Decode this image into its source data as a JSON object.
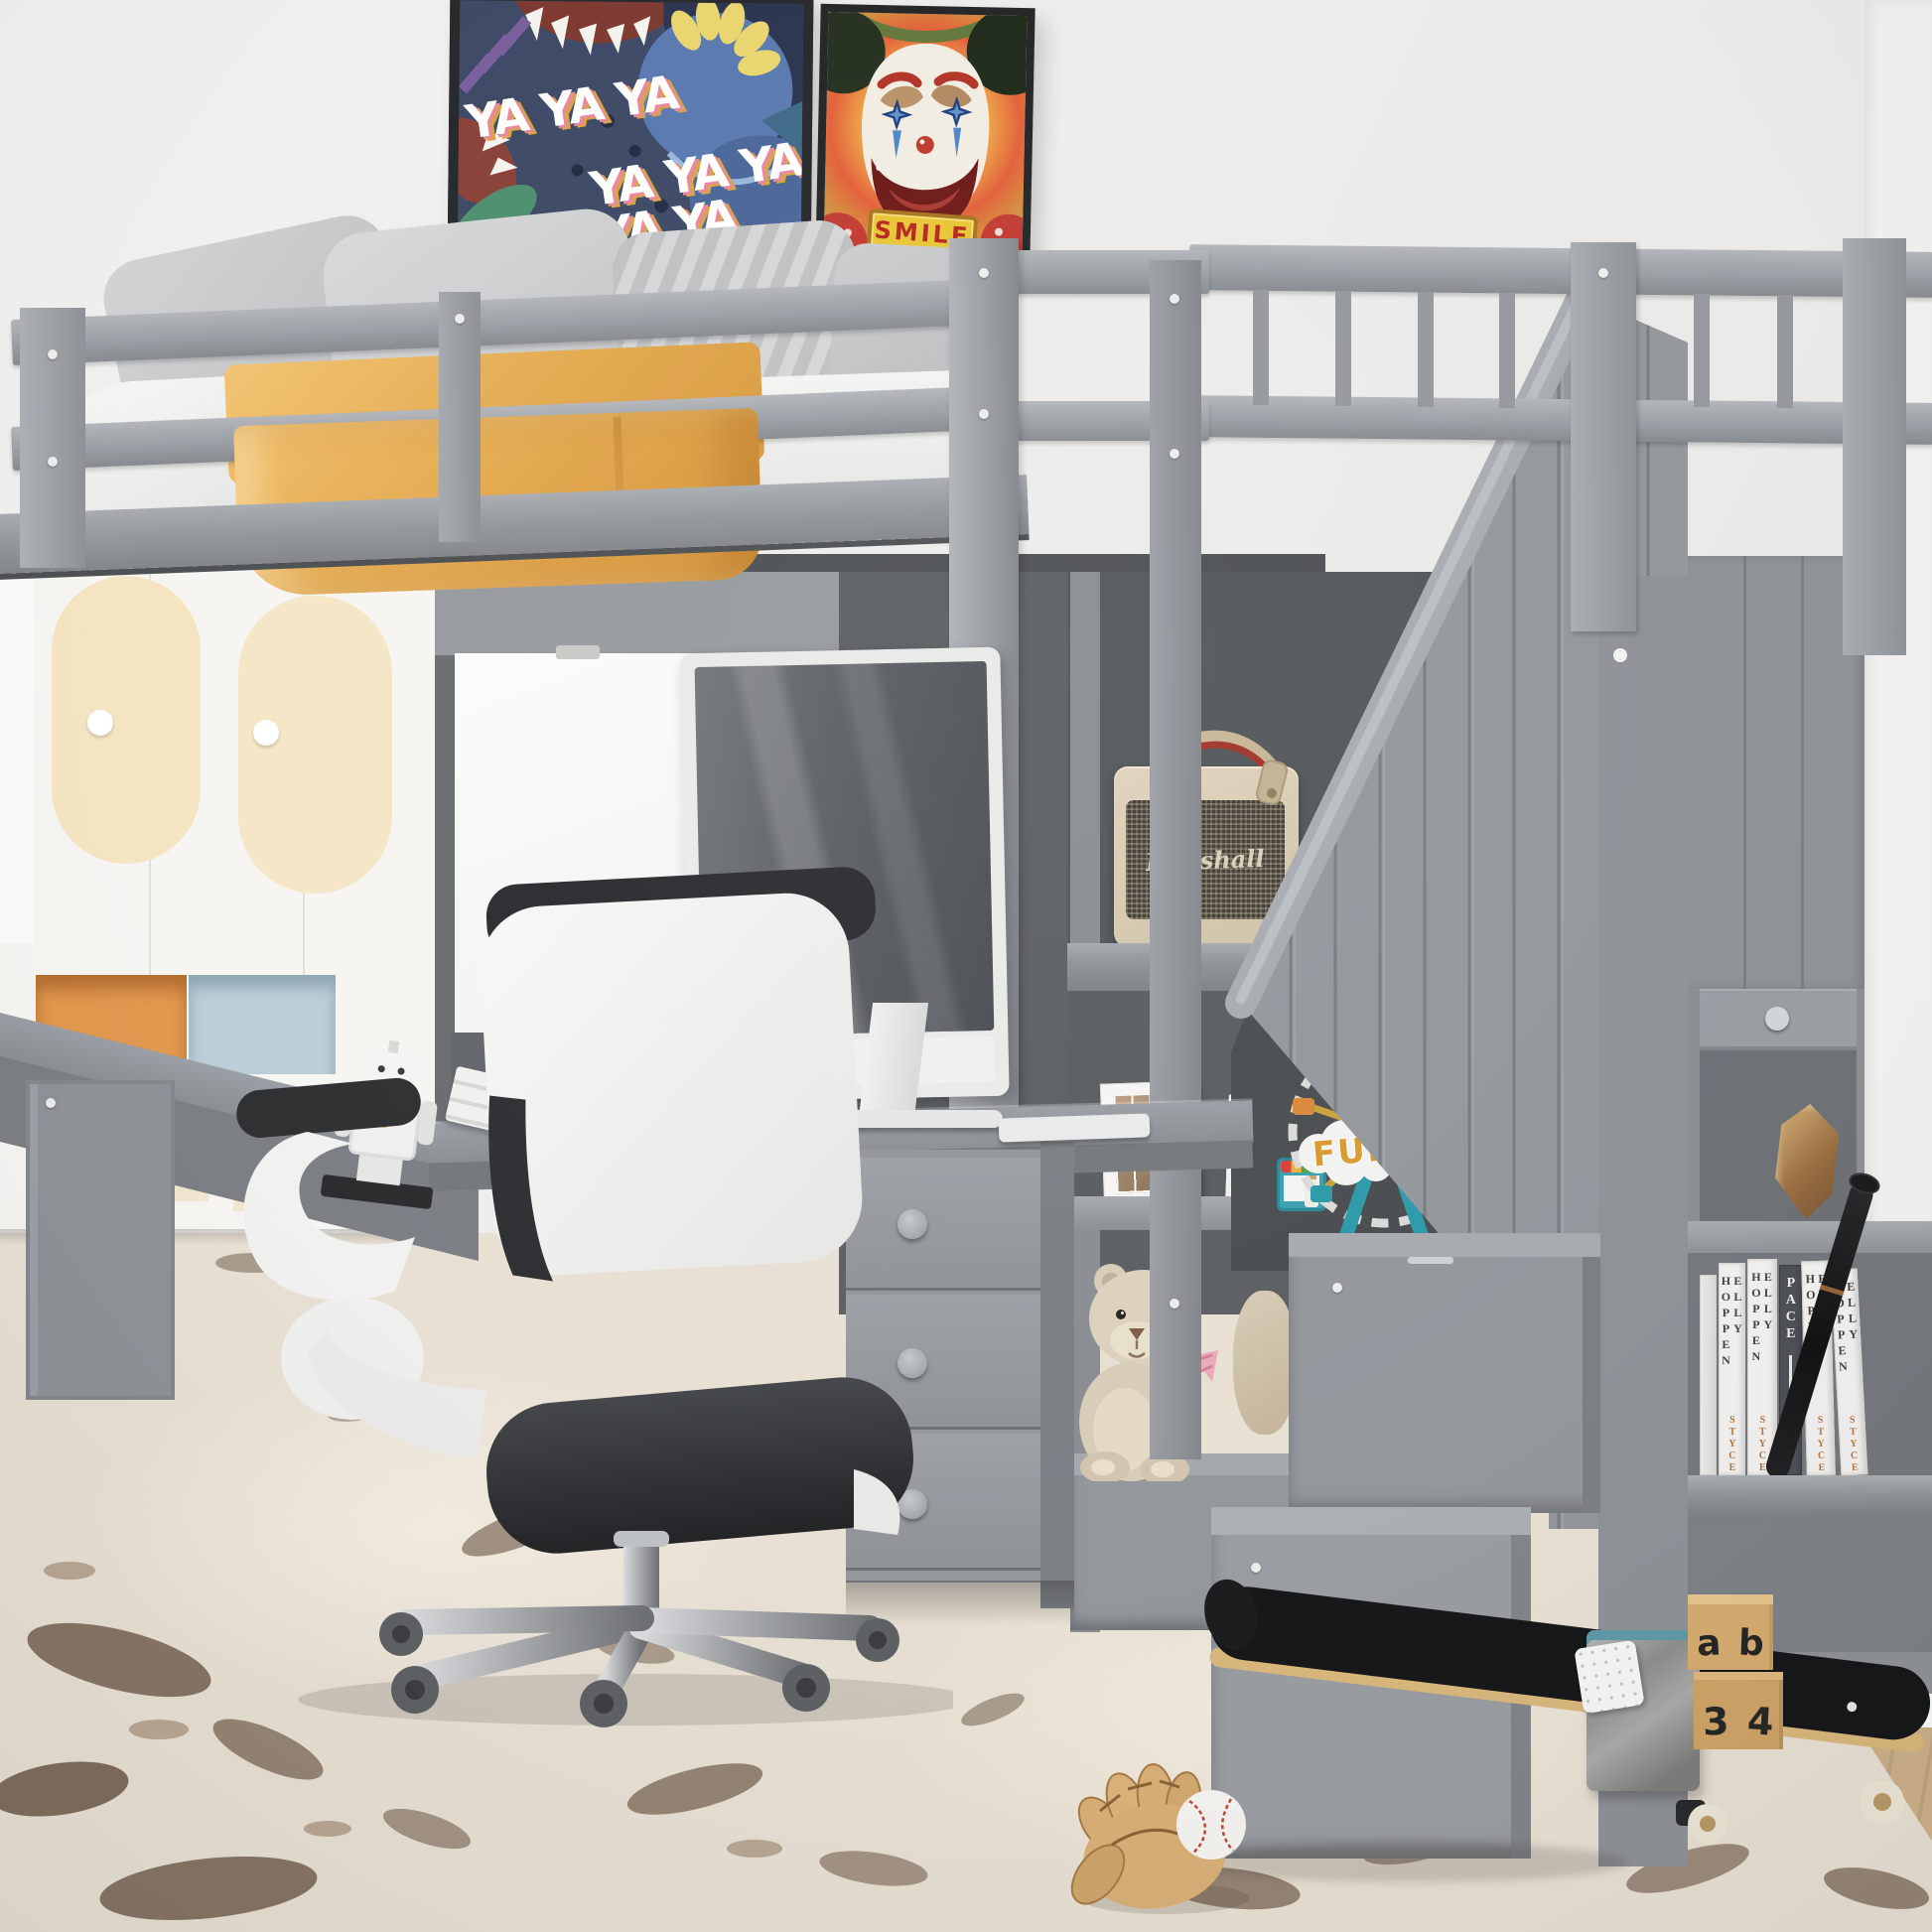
{
  "scene": {
    "title": "Gray twin loft bed with L-shaped desk, storage staircase, shelves and bookcase in a kids room"
  },
  "wall_posters": {
    "graffiti_poster": {
      "text_rows": [
        "YA YA YA",
        "YA YA YA",
        "YA YA YA"
      ]
    },
    "clown_bear_poster": {
      "sign_text": "SMILE"
    }
  },
  "toys": {
    "ferris_wheel_sign": "FUN",
    "letter_blocks": [
      "a",
      "b",
      "3",
      "4"
    ]
  },
  "bookshelf": {
    "books": [
      {
        "spine": "ELLY HOPPEN",
        "accent": "STYCE"
      },
      {
        "spine": "ELLY HOPPEN",
        "accent": "STYCE"
      },
      {
        "spine": "PACE",
        "accent": ""
      },
      {
        "spine": "ELLY HOPPEN",
        "accent": "STYCE"
      },
      {
        "spine": "ELLY HOPPEN",
        "accent": "STYCE"
      }
    ]
  },
  "speaker": {
    "brand_script": "Marshall"
  },
  "colors": {
    "bed_frame_gray": "#9a9ea3",
    "dark_back_panel": "#5c6063",
    "wall": "#eeedec",
    "blanket_yellow": "#e8ae55",
    "rug_base": "#e8e0d3",
    "chair_black": "#2e3033",
    "teddy_cream": "#ddd2bc",
    "book_accent_orange": "#b5743f",
    "block_wood": "#d6ac70",
    "smile_red": "#b5281f",
    "fun_orange": "#d89a2e",
    "poster_navy": "#3e4a66"
  }
}
